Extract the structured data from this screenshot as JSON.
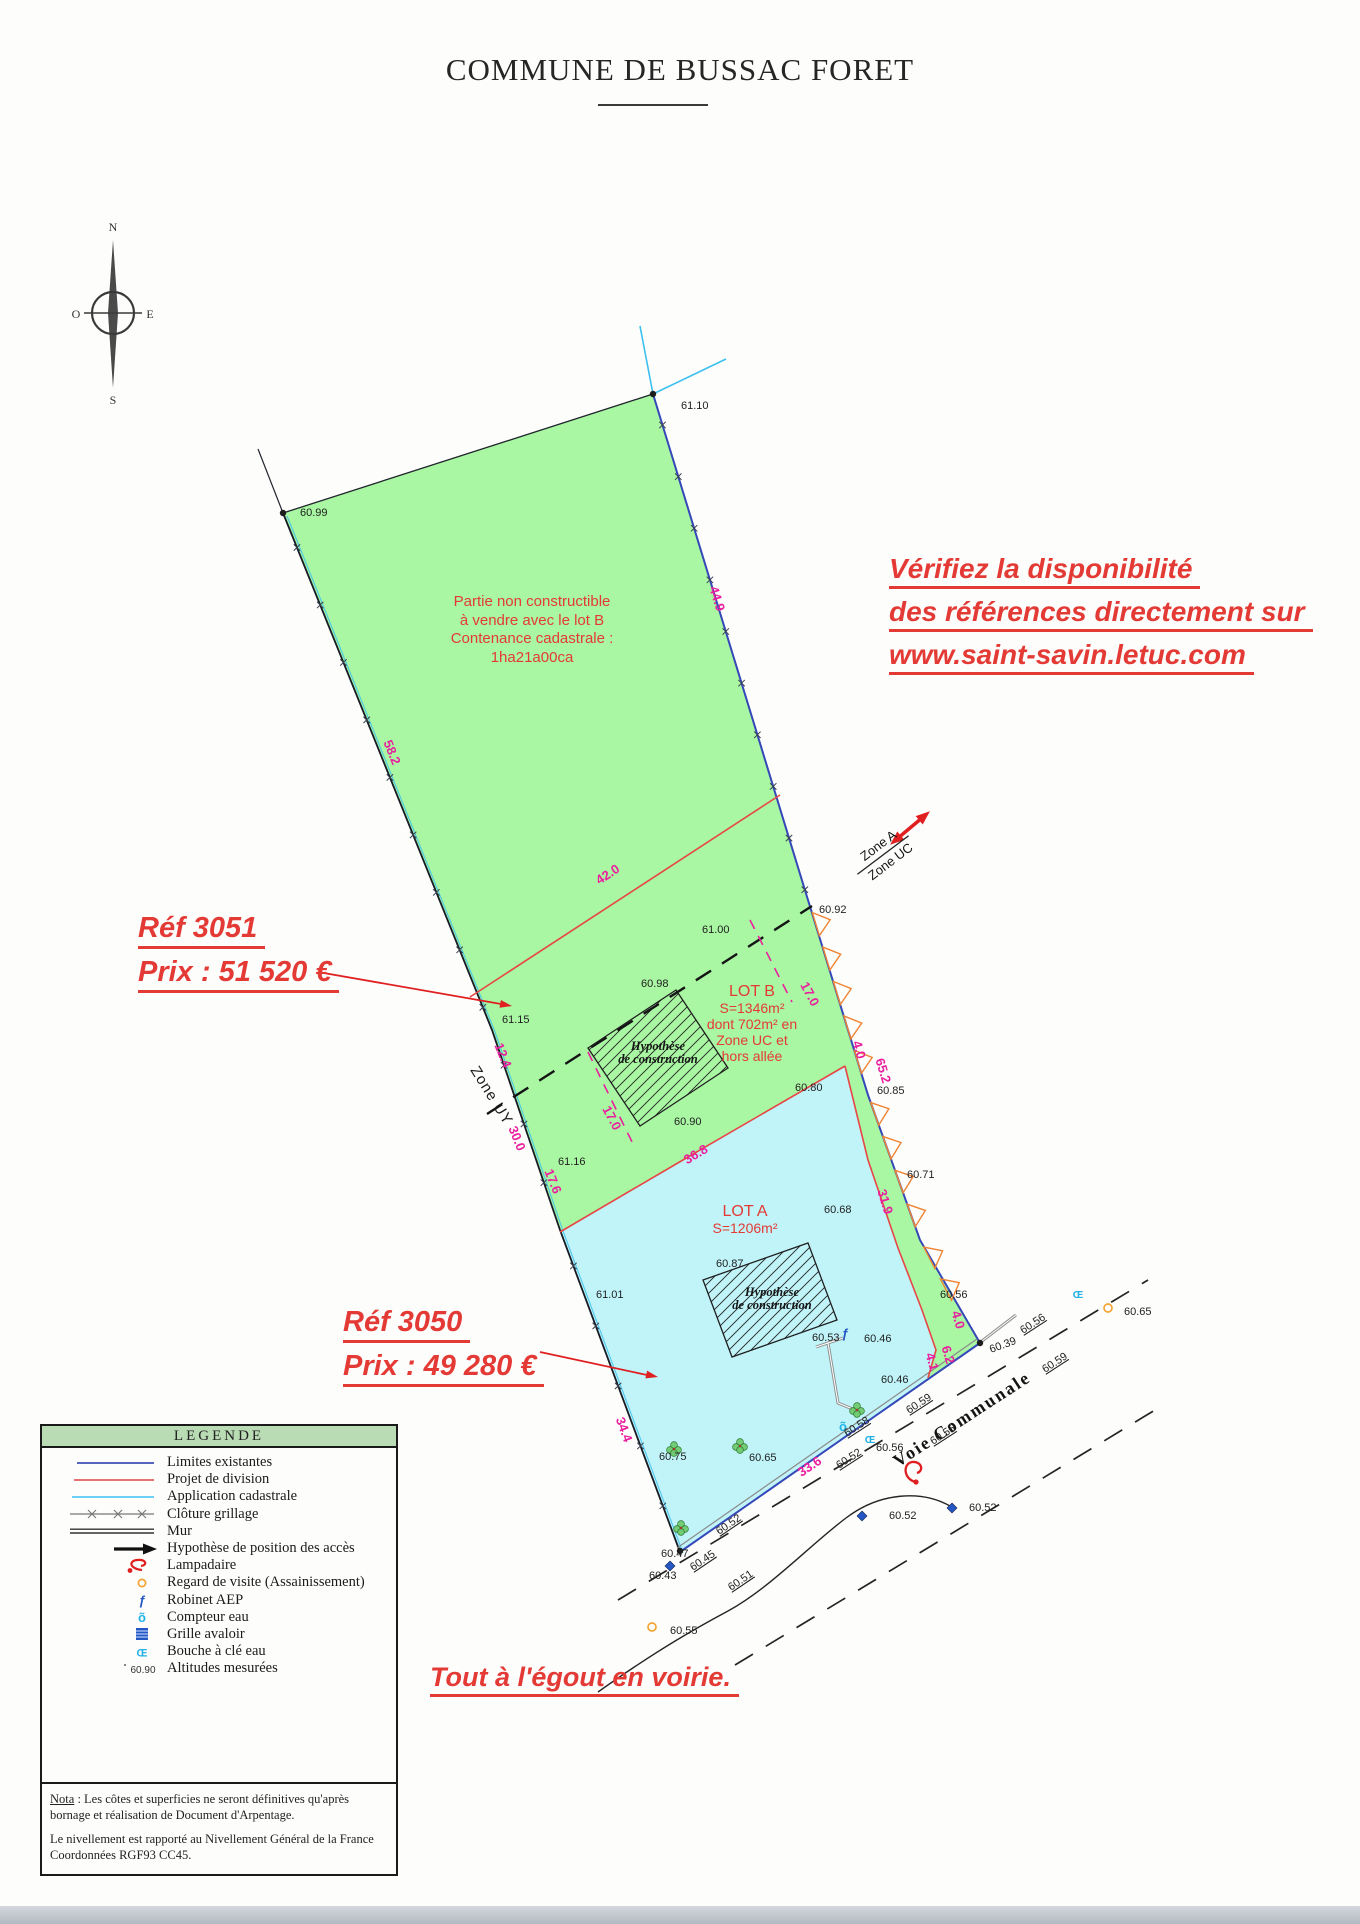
{
  "title": "COMMUNE DE BUSSAC FORET",
  "compass": {
    "n": "N",
    "e": "E",
    "s": "S",
    "o": "O"
  },
  "annotations": {
    "availability": [
      "Vérifiez la disponibilité",
      "des références directement sur",
      "www.saint-savin.letuc.com"
    ],
    "ref_b": {
      "ref": "Réf 3051",
      "price": "Prix : 51 520 €"
    },
    "ref_a": {
      "ref": "Réf 3050",
      "price": "Prix : 49 280 €"
    },
    "sewer": "Tout à l'égout en voirie."
  },
  "parcel": {
    "non_constructible": [
      "Partie non constructible",
      "à vendre avec le lot B",
      "Contenance cadastrale :",
      "1ha21a00ca"
    ],
    "lot_b": [
      "LOT B",
      "S=1346m²",
      "dont 702m² en",
      "Zone UC et",
      "hors allée"
    ],
    "lot_a": [
      "LOT A",
      "S=1206m²"
    ],
    "construction": [
      "Hypothèse",
      "de construction"
    ],
    "zone_a": "Zone A",
    "zone_uc": "Zone UC",
    "zone_uy": "Zone UY",
    "road_name": "Voie Communale"
  },
  "legend": {
    "title": "LEGENDE",
    "items": [
      "Limites existantes",
      "Projet de division",
      "Application cadastrale",
      "Clôture grillage",
      "Mur",
      "Hypothèse de position des accès",
      "Lampadaire",
      "Regard de visite (Assainissement)",
      "Robinet AEP",
      "Compteur eau",
      "Grille avaloir",
      "Bouche à clé eau",
      "Altitudes mesurées"
    ],
    "altitude_sample": "60.90"
  },
  "nota": {
    "label": "Nota",
    "line1": " : Les côtes et superficies ne seront définitives qu'après bornage et réalisation de Document d'Arpentage.",
    "line2": "Le nivellement est rapporté au Nivellement Général de la France Coordonnées RGF93 CC45."
  },
  "map_labels": {
    "elevations": [
      {
        "t": "61.10",
        "x": 681,
        "y": 409
      },
      {
        "t": "60.99",
        "x": 300,
        "y": 516
      },
      {
        "t": "60.92",
        "x": 819,
        "y": 913
      },
      {
        "t": "61.00",
        "x": 702,
        "y": 933
      },
      {
        "t": "60.98",
        "x": 641,
        "y": 987
      },
      {
        "t": "60.90",
        "x": 674,
        "y": 1125
      },
      {
        "t": "60.80",
        "x": 795,
        "y": 1091
      },
      {
        "t": "60.85",
        "x": 877,
        "y": 1094
      },
      {
        "t": "60.71",
        "x": 907,
        "y": 1178
      },
      {
        "t": "60.68",
        "x": 824,
        "y": 1213
      },
      {
        "t": "60.87",
        "x": 716,
        "y": 1267
      },
      {
        "t": "61.01",
        "x": 596,
        "y": 1298
      },
      {
        "t": "61.15",
        "x": 502,
        "y": 1023
      },
      {
        "t": "61.16",
        "x": 558,
        "y": 1165
      },
      {
        "t": "60.56",
        "x": 940,
        "y": 1298
      },
      {
        "t": "60.65",
        "x": 1124,
        "y": 1315
      },
      {
        "t": "60.75",
        "x": 659,
        "y": 1460
      },
      {
        "t": "60.65",
        "x": 749,
        "y": 1461
      },
      {
        "t": "60.53",
        "x": 812,
        "y": 1341
      },
      {
        "t": "60.46",
        "x": 864,
        "y": 1342
      },
      {
        "t": "60.46",
        "x": 881,
        "y": 1383
      },
      {
        "t": "60.39",
        "x": 991,
        "y": 1353,
        "r": -20
      },
      {
        "t": "60.56",
        "x": 1023,
        "y": 1334,
        "r": -33,
        "u": 1
      },
      {
        "t": "60.59",
        "x": 1045,
        "y": 1373,
        "r": -33,
        "u": 1
      },
      {
        "t": "60.59",
        "x": 909,
        "y": 1414,
        "r": -33,
        "u": 1
      },
      {
        "t": "60.55",
        "x": 933,
        "y": 1445,
        "r": -33,
        "u": 1
      },
      {
        "t": "60.56",
        "x": 876,
        "y": 1451
      },
      {
        "t": "60.58",
        "x": 847,
        "y": 1437,
        "r": -33,
        "u": 1
      },
      {
        "t": "60.52",
        "x": 839,
        "y": 1469,
        "r": -33,
        "u": 1
      },
      {
        "t": "60.52",
        "x": 969,
        "y": 1511
      },
      {
        "t": "60.52",
        "x": 889,
        "y": 1519
      },
      {
        "t": "60.52",
        "x": 719,
        "y": 1535,
        "r": -34,
        "u": 1
      },
      {
        "t": "60.51",
        "x": 731,
        "y": 1591,
        "r": -34,
        "u": 1
      },
      {
        "t": "60.47",
        "x": 661,
        "y": 1557
      },
      {
        "t": "60.45",
        "x": 693,
        "y": 1571,
        "r": -34,
        "u": 1
      },
      {
        "t": "60.43",
        "x": 649,
        "y": 1579
      },
      {
        "t": "60.55",
        "x": 670,
        "y": 1634
      }
    ],
    "measurements": [
      {
        "t": "44.9",
        "x": 713,
        "y": 600,
        "r": 73
      },
      {
        "t": "58.2",
        "x": 388,
        "y": 754,
        "r": 68
      },
      {
        "t": "42.0",
        "x": 610,
        "y": 878,
        "r": -33
      },
      {
        "t": "17.0",
        "x": 806,
        "y": 996,
        "r": 62
      },
      {
        "t": "17.0",
        "x": 608,
        "y": 1120,
        "r": 62
      },
      {
        "t": "12.4",
        "x": 499,
        "y": 1057,
        "r": 68
      },
      {
        "t": "30.0",
        "x": 513,
        "y": 1140,
        "r": 68
      },
      {
        "t": "17.6",
        "x": 549,
        "y": 1183,
        "r": 68
      },
      {
        "t": "36.8",
        "x": 698,
        "y": 1158,
        "r": -31
      },
      {
        "t": "4.0",
        "x": 855,
        "y": 1051,
        "r": 73
      },
      {
        "t": "65.2",
        "x": 879,
        "y": 1072,
        "r": 73
      },
      {
        "t": "31.9",
        "x": 881,
        "y": 1203,
        "r": 73
      },
      {
        "t": "34.4",
        "x": 620,
        "y": 1431,
        "r": 70
      },
      {
        "t": "33.6",
        "x": 812,
        "y": 1470,
        "r": -34
      },
      {
        "t": "4.0",
        "x": 954,
        "y": 1321,
        "r": 73
      },
      {
        "t": "6.2",
        "x": 944,
        "y": 1356,
        "r": 73
      },
      {
        "t": "4.1",
        "x": 928,
        "y": 1363,
        "r": 73
      }
    ]
  },
  "map_symbols": [
    {
      "type": "dot",
      "x": 653,
      "y": 394
    },
    {
      "type": "dot",
      "x": 283,
      "y": 513
    },
    {
      "type": "dot",
      "x": 980,
      "y": 1343
    },
    {
      "type": "dot",
      "x": 680,
      "y": 1551
    },
    {
      "type": "tree",
      "x": 674,
      "y": 1449
    },
    {
      "type": "tree",
      "x": 740,
      "y": 1446
    },
    {
      "type": "tree",
      "x": 857,
      "y": 1410
    },
    {
      "type": "tree",
      "x": 681,
      "y": 1528
    },
    {
      "type": "grille",
      "x": 670,
      "y": 1566
    },
    {
      "type": "grille",
      "x": 862,
      "y": 1516
    },
    {
      "type": "grille",
      "x": 952,
      "y": 1508
    },
    {
      "type": "robinet",
      "x": 845,
      "y": 1334
    },
    {
      "type": "compteur",
      "x": 843,
      "y": 1427
    },
    {
      "type": "bouche",
      "x": 870,
      "y": 1439
    },
    {
      "type": "bouche",
      "x": 1078,
      "y": 1294
    },
    {
      "type": "regard",
      "x": 652,
      "y": 1627
    },
    {
      "type": "regard",
      "x": 1108,
      "y": 1308
    },
    {
      "type": "lampadaire",
      "x": 914,
      "y": 1470
    }
  ],
  "colors": {
    "parcel_green": "#a9f6a3",
    "lot_a_cyan": "#c0f4f9",
    "boundary_blue": "#3548b8",
    "cadastre_cyan": "#3cc0f0",
    "division_red": "#e84545",
    "dimension_magenta": "#ea1f9e",
    "annotation_red": "#e43a35",
    "talus_orange": "#ef8432"
  }
}
